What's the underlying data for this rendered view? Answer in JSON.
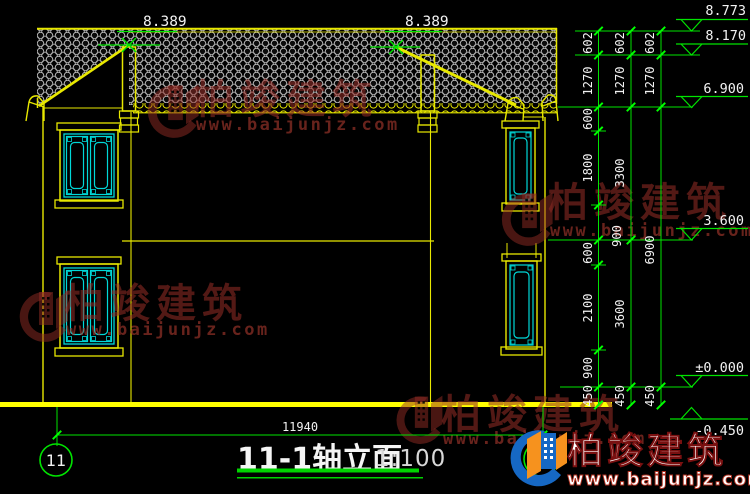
{
  "title": {
    "name": "11-1轴立面",
    "scale": "1:100"
  },
  "drawing": {
    "span_dim": "11940",
    "grid_bubble_left": "11",
    "grid_bubble_right": "1",
    "ridge_dim_left": "8.389",
    "ridge_dim_right": "8.389"
  },
  "elevation_markers": [
    {
      "label": "8.773"
    },
    {
      "label": "8.170"
    },
    {
      "label": "6.900"
    },
    {
      "label": "3.600"
    },
    {
      "label": "±0.000"
    },
    {
      "label": "-0.450"
    }
  ],
  "vdims": {
    "chain1": [
      "602",
      "1270",
      "600",
      "1800",
      "900",
      "600",
      "2100",
      "900",
      "450"
    ],
    "chain2": [
      "602",
      "1270",
      "3300",
      "3600",
      "450"
    ],
    "chain3": [
      "602",
      "1270",
      "6900",
      "450"
    ]
  },
  "watermark": {
    "brand": "柏竣建筑",
    "url": "www.baijunjz.com"
  },
  "logo": {
    "brand": "柏竣建筑",
    "url": "www.baijunjz.com"
  },
  "colors": {
    "background": "#000000",
    "building_line": "#e8e800",
    "dimension_green": "#00e400",
    "window_cyan": "#00d8d8",
    "text_white": "#f2f2f2",
    "watermark_red": "#8a2a22",
    "logo_blue": "#1668c4",
    "logo_orange": "#f6921e"
  }
}
